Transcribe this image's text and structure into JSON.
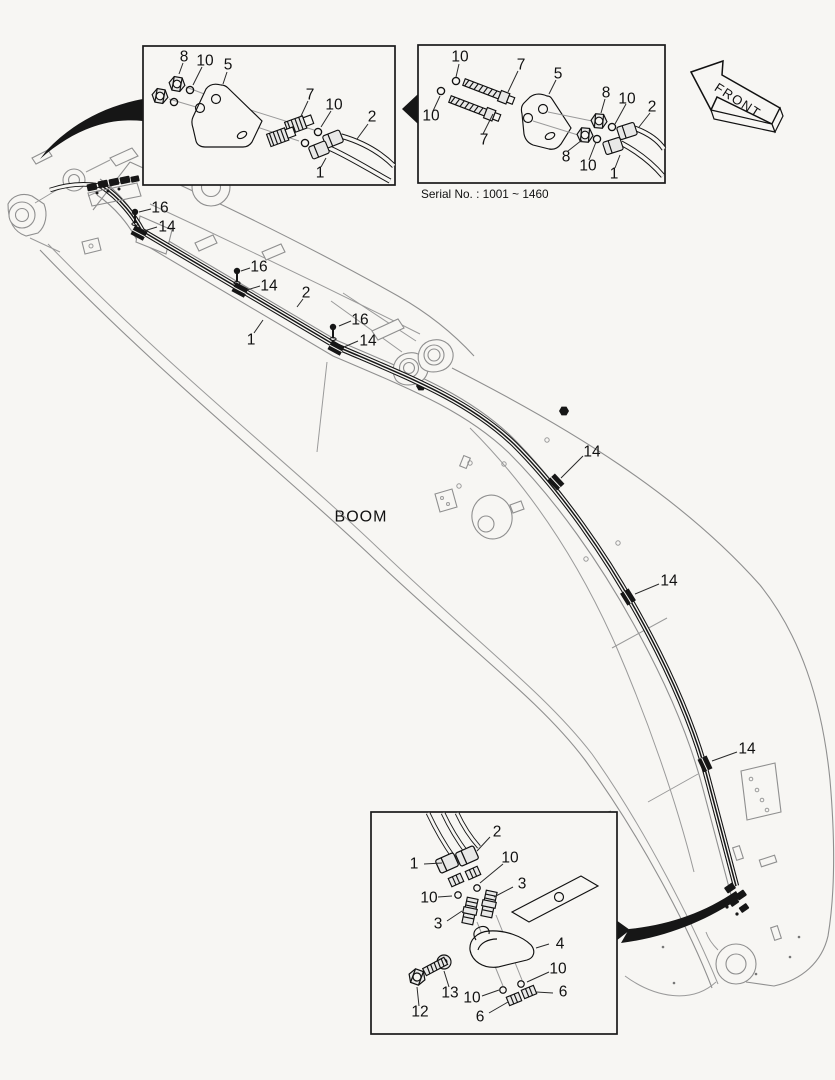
{
  "insets": {
    "top_left": {
      "labels": [
        "8",
        "10",
        "5",
        "7",
        "10",
        "2",
        "1"
      ]
    },
    "top_right": {
      "labels": [
        "10",
        "7",
        "5",
        "8",
        "10",
        "2",
        "10",
        "7",
        "8",
        "10",
        "1"
      ],
      "caption": "Serial No. : 1001 ~ 1460"
    },
    "bottom": {
      "labels": [
        "2",
        "1",
        "10",
        "10",
        "3",
        "3",
        "4",
        "10",
        "13",
        "10",
        "6",
        "12",
        "6"
      ]
    }
  },
  "main": {
    "boom_label": "BOOM",
    "labels": [
      "16",
      "14",
      "16",
      "14",
      "2",
      "1",
      "16",
      "14",
      "14",
      "14",
      "14"
    ]
  },
  "front_arrow": {
    "label": "FRONT"
  },
  "colors": {
    "background": "#f7f6f3",
    "ink": "#1a1a1a",
    "boom_line": "#8f8f8f"
  }
}
